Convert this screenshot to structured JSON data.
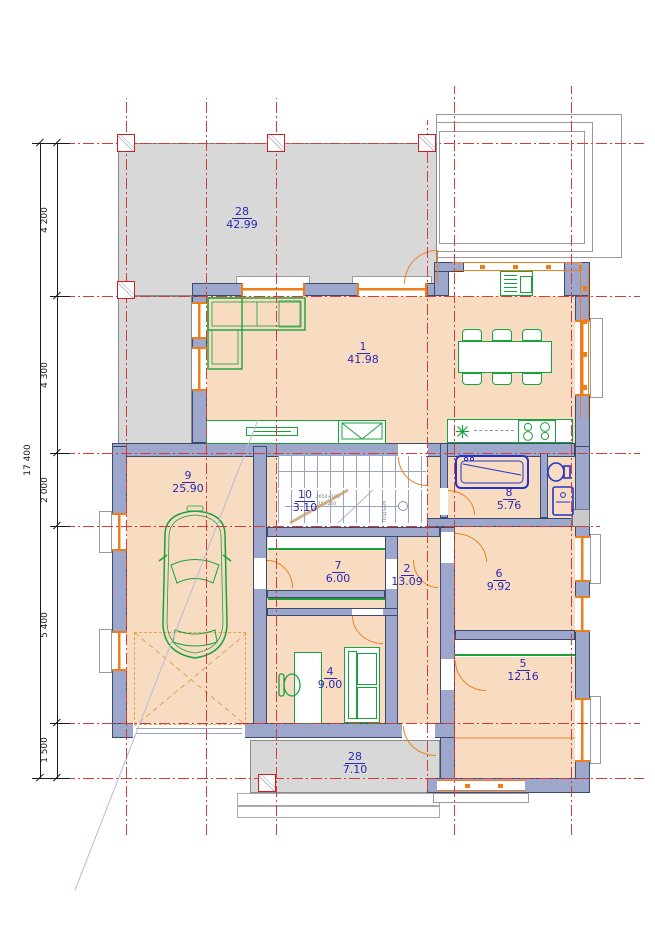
{
  "drawing": {
    "type_label": "first-floor-plan",
    "dimensions": {
      "total": "17 400",
      "segments": [
        "4 200",
        "4 300",
        "2 000",
        "5 400",
        "1 500"
      ]
    },
    "rooms": [
      {
        "number": "28",
        "area": "42.99",
        "name": "terrace-top"
      },
      {
        "number": "1",
        "area": "41.98",
        "name": "living-dining"
      },
      {
        "number": "9",
        "area": "25.90",
        "name": "garage"
      },
      {
        "number": "10",
        "area": "3.10",
        "name": "stair-hall"
      },
      {
        "number": "8",
        "area": "5.76",
        "name": "bathroom"
      },
      {
        "number": "7",
        "area": "6.00",
        "name": "corridor"
      },
      {
        "number": "2",
        "area": "13.09",
        "name": "hall"
      },
      {
        "number": "6",
        "area": "9.92",
        "name": "room-6"
      },
      {
        "number": "4",
        "area": "9.00",
        "name": "study"
      },
      {
        "number": "5",
        "area": "12.16",
        "name": "room-5"
      },
      {
        "number": "28",
        "area": "7.10",
        "name": "terrace-bottom"
      }
    ],
    "stair_notes": {
      "direction": "ПОДЪЕМ",
      "spec_line1": "2650×180",
      "spec_line2": "15×250"
    },
    "colors": {
      "grid_red": "#d43c3c",
      "wall_fill": "#9ca7cb",
      "wall_stroke": "#3c4a6e",
      "floor_orange": "#f8dcc2",
      "terrace_gray": "#d8d8d8",
      "furniture_green": "#17a23c",
      "door_orange": "#e8821e",
      "sanitary_blue": "#2334c8",
      "label_blue": "#2a2ab2"
    }
  }
}
